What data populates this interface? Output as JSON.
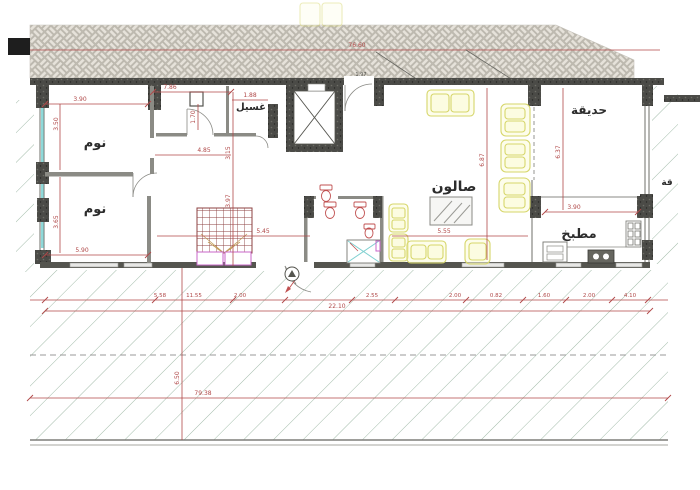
{
  "drawing": {
    "type_label": "architectural-floor-plan",
    "rooms": {
      "bedroom_top": "نوم",
      "bedroom_bottom": "نوم",
      "laundry": "غسيل",
      "salon": "صالون",
      "kitchen": "مطبخ",
      "garden": "حديقة",
      "garden_partial": "قة"
    },
    "dims": {
      "top_total": "76.60",
      "b1_w": "3.90",
      "b1_h": "3.50",
      "b2_h": "3.65",
      "b2_w": "5.90",
      "hall_w": "7.86",
      "hall_h": "1.70",
      "hall_inner": "4.85",
      "laundry_w": "1.88",
      "shaft_h": "3.15",
      "stair_h": "3.97",
      "stair_span": "5.45",
      "salon_span": "5.55",
      "salon_h": "6.87",
      "garden_h": "6.37",
      "kitchen_w": "3.90",
      "door_tag": "1.97",
      "row1": [
        "5.58",
        "11.55",
        "2.00",
        "2.55",
        "2.00",
        "0.82",
        "1.60",
        "2.00",
        "4.10"
      ],
      "row2_total": "22.10",
      "row3_total": "79.38",
      "depth": "6.50"
    },
    "colors": {
      "dim_red": "#b04848",
      "wall_dark": "#4b4b47",
      "masonry_line": "#b9b5ab",
      "hatch_green": "#a3bcaa",
      "glazing_cyan": "#8fd9d9",
      "furniture_yellow": "#d6d66a",
      "stair_maroon": "#8c4242",
      "magenta": "#c966c9"
    }
  }
}
